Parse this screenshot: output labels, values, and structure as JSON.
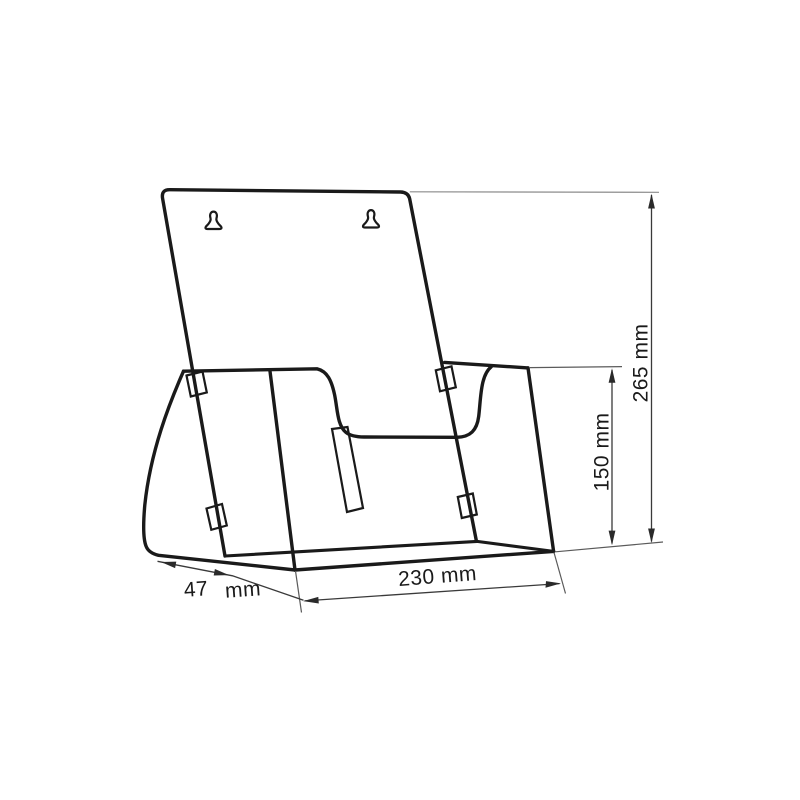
{
  "figure": {
    "type": "technical-line-drawing",
    "subject": "wall-mounted brochure holder with keyhole mounting slots",
    "background": "#ffffff",
    "colors": {
      "outline": "#1a1a1a",
      "dimension_lines": "#3a3a3a",
      "extension_line": "#8c8c8c",
      "label_text": "#1a1a1a"
    },
    "icons": {
      "left_mount": "keyhole-slot-icon",
      "right_mount": "keyhole-slot-icon"
    },
    "dimensions": {
      "overall_height": {
        "label": "265 mm"
      },
      "pocket_height": {
        "label": "150 mm"
      },
      "overall_width": {
        "label": "230 mm"
      },
      "base_depth": {
        "value": "47",
        "unit": "mm"
      }
    }
  }
}
